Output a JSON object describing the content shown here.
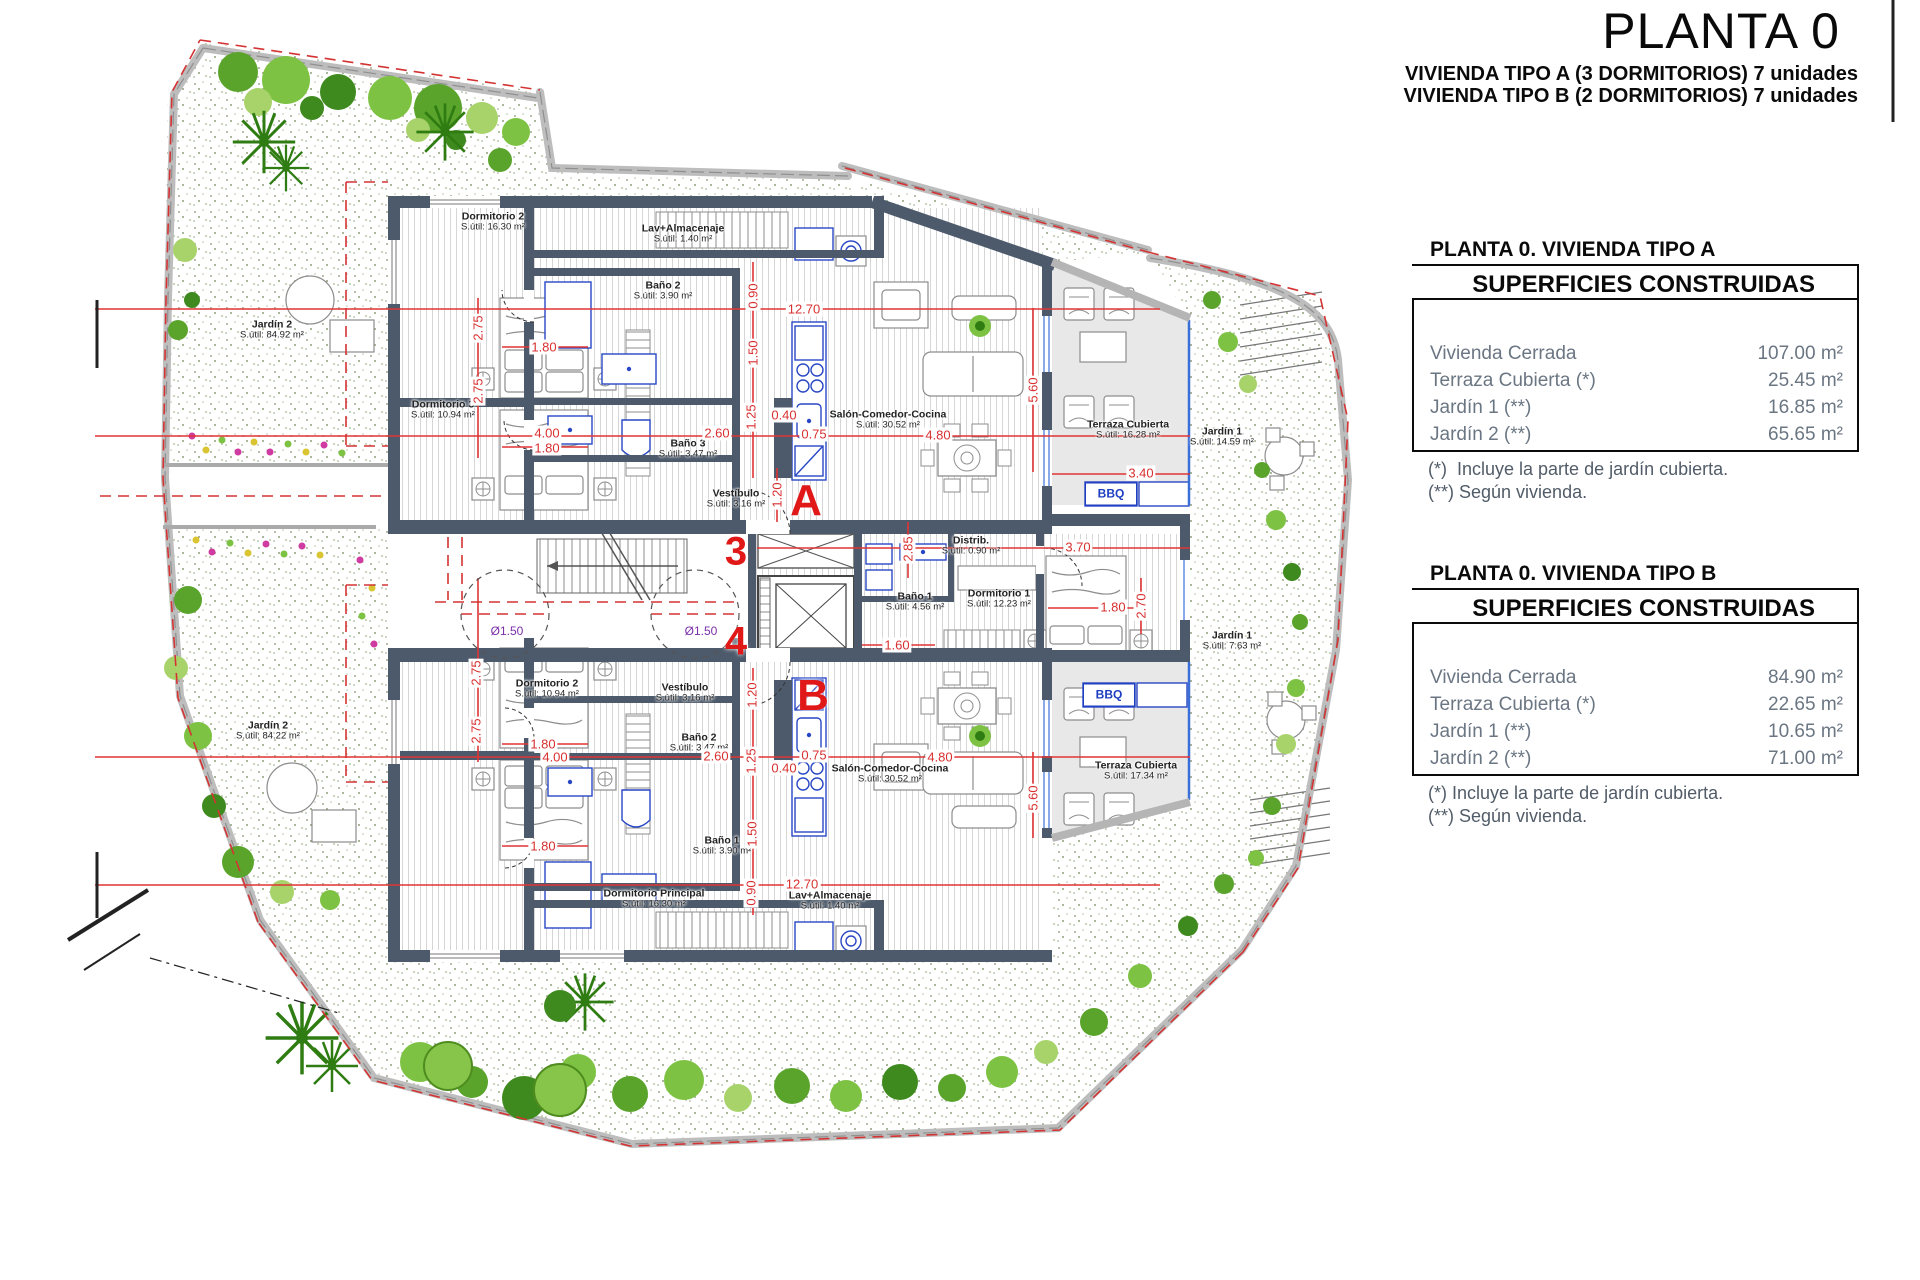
{
  "title_block": {
    "title": "PLANTA 0",
    "subtitle_line1": "VIVIENDA TIPO A (3 DORMITORIOS) 7 unidades",
    "subtitle_line2": "VIVIENDA TIPO B (2 DORMITORIOS) 7 unidades"
  },
  "tables": [
    {
      "heading": "PLANTA 0. VIVIENDA TIPO A",
      "box_title": "SUPERFICIES CONSTRUIDAS",
      "rows": [
        {
          "label": "Vivienda Cerrada",
          "value": "107.00 m²"
        },
        {
          "label": "Terraza Cubierta  (*)",
          "value": "25.45 m²"
        },
        {
          "label": "Jardín 1 (**)",
          "value": "16.85 m²"
        },
        {
          "label": "Jardín 2 (**)",
          "value": "65.65 m²"
        }
      ],
      "notes": [
        "(*)  Incluye la parte de jardín cubierta.",
        "(**) Según vivienda."
      ]
    },
    {
      "heading": "PLANTA 0. VIVIENDA TIPO B",
      "box_title": "SUPERFICIES CONSTRUIDAS",
      "rows": [
        {
          "label": "Vivienda Cerrada",
          "value": "84.90 m²"
        },
        {
          "label": "Terraza Cubierta (*)",
          "value": "22.65 m²"
        },
        {
          "label": "Jardín 1 (**)",
          "value": "10.65 m²"
        },
        {
          "label": "Jardín 2 (**)",
          "value": "71.00 m²"
        }
      ],
      "notes": [
        "(*) Incluye la parte de jardín cubierta.",
        "(**) Según vivienda."
      ]
    }
  ],
  "plan": {
    "markers": {
      "unit_a": "A",
      "unit_b": "B",
      "portal_3": "3",
      "portal_4": "4"
    },
    "bbq": "BBQ",
    "diameter": "Ø1.50",
    "rooms": [
      {
        "name": "Dormitorio 2",
        "area": "S.útil: 16.30 m²"
      },
      {
        "name": "Lav+Almacenaje",
        "area": "S.útil: 1.40 m²"
      },
      {
        "name": "Baño 2",
        "area": "S.útil: 3.90 m²"
      },
      {
        "name": "Dormitorio 3",
        "area": "S.útil: 10.94 m²"
      },
      {
        "name": "Baño 3",
        "area": "S.útil: 3.47 m²"
      },
      {
        "name": "Vestíbulo",
        "area": "S.útil: 3.16 m²"
      },
      {
        "name": "Salón-Comedor-Cocina",
        "area": "S.útil: 30.52 m²"
      },
      {
        "name": "Terraza Cubierta",
        "area": "S.útil: 16.28 m²"
      },
      {
        "name": "Distrib.",
        "area": "S.útil: 0.90 m²"
      },
      {
        "name": "Baño 1",
        "area": "S.útil: 4.56 m²"
      },
      {
        "name": "Dormitorio 1",
        "area": "S.útil: 12.23 m²"
      },
      {
        "name": "Dormitorio 2",
        "area": "S.útil: 10.94 m²"
      },
      {
        "name": "Vestíbulo",
        "area": "S.útil: 3.16 m²"
      },
      {
        "name": "Baño 2",
        "area": "S.útil: 3.47 m²"
      },
      {
        "name": "Baño 1",
        "area": "S.útil: 3.90 m²"
      },
      {
        "name": "Dormitorio Principal",
        "area": "S.útil: 16.30 m²"
      },
      {
        "name": "Lav+Almacenaje",
        "area": "S.útil: 1.40 m²"
      },
      {
        "name": "Salón-Comedor-Cocina",
        "area": "S.útil: 30.52 m²"
      },
      {
        "name": "Terraza Cubierta",
        "area": "S.útil: 17.34 m²"
      },
      {
        "name": "Jardín 2",
        "area": "S.útil: 84.92 m²"
      },
      {
        "name": "Jardín 2",
        "area": "S.útil: 84.22 m²"
      },
      {
        "name": "Jardín 1",
        "area": "S.útil: 14.59 m²"
      },
      {
        "name": "Jardín 1",
        "area": "S.útil: 7.63 m²"
      }
    ],
    "dimensions": [
      "12.70",
      "0.90",
      "2.75",
      "1.80",
      "1.50",
      "2.60",
      "1.25",
      "0.40",
      "0.75",
      "4.00",
      "1.80",
      "2.75",
      "4.80",
      "5.60",
      "3.40",
      "1.20",
      "2.85",
      "3.70",
      "1.80",
      "2.70",
      "1.60",
      "1.20",
      "2.60",
      "0.40",
      "0.75",
      "1.25",
      "1.80",
      "4.00",
      "2.75",
      "2.75",
      "4.80",
      "5.60",
      "1.80",
      "1.50",
      "0.90",
      "12.70"
    ],
    "colors": {
      "wall": "#4d5a6b",
      "dimension_red": "#d83030",
      "marker_red": "#e01818",
      "fixture_blue": "#2947c4",
      "terrace_gray": "#e8e8e8",
      "garden_green": "#7dc242",
      "diameter_purple": "#7b2fa8"
    }
  }
}
